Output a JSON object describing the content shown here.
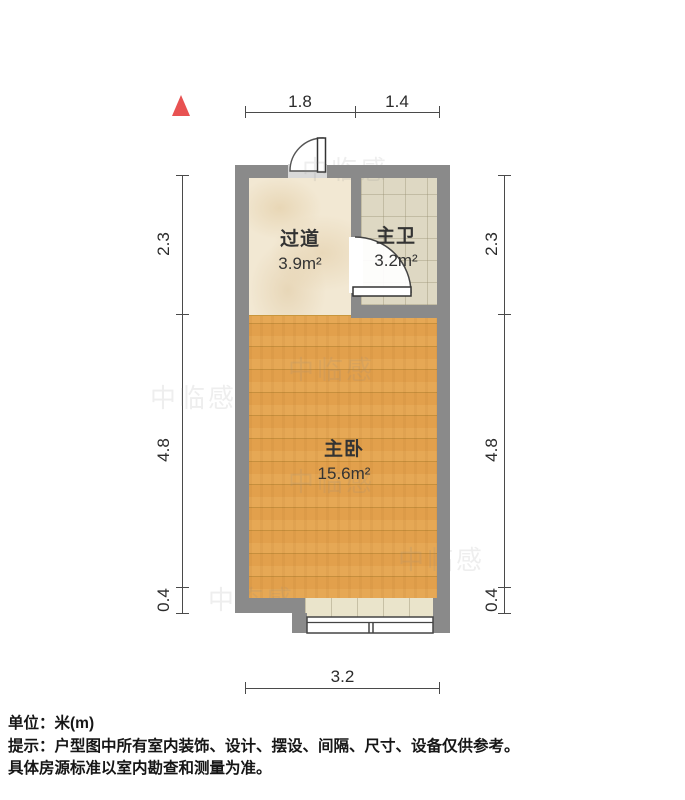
{
  "plan": {
    "rooms": [
      {
        "name": "过道",
        "area": "3.9m²"
      },
      {
        "name": "主卫",
        "area": "3.2m²"
      },
      {
        "name": "主卧",
        "area": "15.6m²"
      }
    ],
    "dimensions": {
      "top": [
        "1.8",
        "1.4"
      ],
      "left": [
        "2.3",
        "4.8",
        "0.4"
      ],
      "right": [
        "2.3",
        "4.8",
        "0.4"
      ],
      "bottom": [
        "3.2"
      ]
    }
  },
  "footer": {
    "unit": "单位：米(m)",
    "tip": "提示：户型图中所有室内装饰、设计、摆设、间隔、尺寸、设备仅供参考。",
    "tip2": "具体房源标准以室内勘查和测量为准。"
  },
  "watermark": {
    "text": "中临感"
  },
  "colors": {
    "wall": "#8a8a8a",
    "wood_floor": "#e4a24f",
    "hall_floor": "#f2e8d3",
    "bath_floor": "#ded8c3",
    "sill": "#eae4cb",
    "north_arrow": "#e85252",
    "dim_line": "#4a4a4a"
  }
}
